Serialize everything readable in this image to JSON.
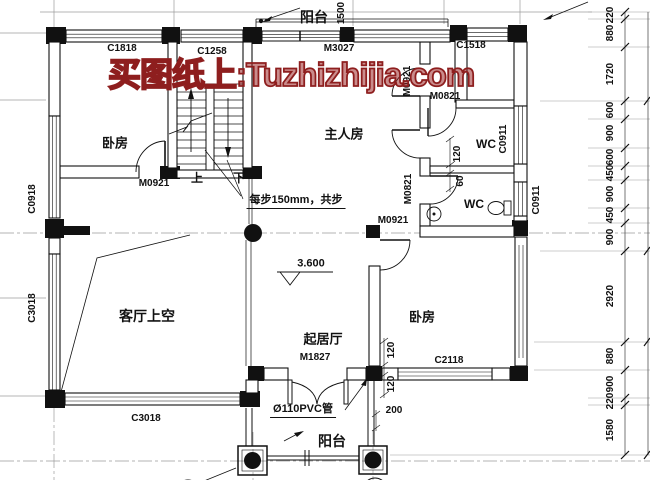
{
  "title": "second-floor house plan drawing",
  "watermark": {
    "text": "买图纸上:Tuzhizhijia.com",
    "color": "#8e1e1e"
  },
  "colors": {
    "line": "#1a1a1a",
    "grid": "#9b9b9b",
    "watermark": "#8e1e1e",
    "background": "#ffffff"
  },
  "labels": [
    {
      "name": "balcony-top-label",
      "text": "阳台",
      "x": 314,
      "y": 17,
      "fs": 14
    },
    {
      "name": "window-c1818-label",
      "text": "C1818",
      "x": 122,
      "y": 49,
      "fs": 10
    },
    {
      "name": "window-c1258-label",
      "text": "C1258",
      "x": 212,
      "y": 52,
      "fs": 10
    },
    {
      "name": "door-m3027-label",
      "text": "M3027",
      "x": 339,
      "y": 49,
      "fs": 10
    },
    {
      "name": "window-c1518-label",
      "text": "C1518",
      "x": 471,
      "y": 46,
      "fs": 10
    },
    {
      "name": "dim-1500-label",
      "text": "1500",
      "x": 342,
      "y": 13,
      "fs": 10,
      "rot": 1
    },
    {
      "name": "door-m0921-corridor-label",
      "text": "M0921",
      "x": 408,
      "y": 81,
      "fs": 10,
      "rot": 1
    },
    {
      "name": "door-m0821-top-label",
      "text": "M0821",
      "x": 445,
      "y": 97,
      "fs": 10
    },
    {
      "name": "wc-upper-label",
      "text": "WC",
      "x": 486,
      "y": 144,
      "fs": 12
    },
    {
      "name": "window-c0911-upper-label",
      "text": "C0911",
      "x": 504,
      "y": 139,
      "fs": 10,
      "rot": 1
    },
    {
      "name": "dim-120-wc-label",
      "text": "120",
      "x": 458,
      "y": 154,
      "fs": 10,
      "rot": 1
    },
    {
      "name": "dim-60-wc-label",
      "text": "60",
      "x": 461,
      "y": 181,
      "fs": 10,
      "rot": 1
    },
    {
      "name": "door-m0821-lower-label",
      "text": "M0821",
      "x": 409,
      "y": 189,
      "fs": 10,
      "rot": 1
    },
    {
      "name": "wc-lower-label",
      "text": "WC",
      "x": 474,
      "y": 204,
      "fs": 12
    },
    {
      "name": "window-c0911-right-label",
      "text": "C0911",
      "x": 537,
      "y": 200,
      "fs": 10,
      "rot": 1
    },
    {
      "name": "room-master-label",
      "text": "主人房",
      "x": 344,
      "y": 134,
      "fs": 13
    },
    {
      "name": "room-bedroom-upperleft-label",
      "text": "卧房",
      "x": 115,
      "y": 143,
      "fs": 13
    },
    {
      "name": "door-m0921-bedroom1-label",
      "text": "M0921",
      "x": 154,
      "y": 184,
      "fs": 10
    },
    {
      "name": "stair-up-label",
      "text": "上",
      "x": 197,
      "y": 178,
      "fs": 12
    },
    {
      "name": "stair-down-label",
      "text": "下",
      "x": 239,
      "y": 178,
      "fs": 12
    },
    {
      "name": "stair-note-label",
      "text": "每步150mm，共步",
      "x": 296,
      "y": 202,
      "fs": 11,
      "u": 1
    },
    {
      "name": "door-m0921-bedroom2-label",
      "text": "M0921",
      "x": 393,
      "y": 221,
      "fs": 10
    },
    {
      "name": "window-c0918-label",
      "text": "C0918",
      "x": 33,
      "y": 199,
      "fs": 10,
      "rot": 1
    },
    {
      "name": "window-c3018-left-label",
      "text": "C3018",
      "x": 33,
      "y": 308,
      "fs": 10,
      "rot": 1
    },
    {
      "name": "room-void-label",
      "text": "客厅上空",
      "x": 147,
      "y": 316,
      "fs": 14
    },
    {
      "name": "level-3600-label",
      "text": "3.600",
      "x": 311,
      "y": 264,
      "fs": 11
    },
    {
      "name": "room-family-label",
      "text": "起居厅",
      "x": 323,
      "y": 339,
      "fs": 13
    },
    {
      "name": "door-m1827-label",
      "text": "M1827",
      "x": 315,
      "y": 358,
      "fs": 10
    },
    {
      "name": "room-bedroom-lowerright-label",
      "text": "卧房",
      "x": 422,
      "y": 317,
      "fs": 13
    },
    {
      "name": "window-c2118-label",
      "text": "C2118",
      "x": 449,
      "y": 361,
      "fs": 10
    },
    {
      "name": "dim-120-a-label",
      "text": "120",
      "x": 392,
      "y": 350,
      "fs": 10,
      "rot": 1
    },
    {
      "name": "dim-120-b-label",
      "text": "120",
      "x": 392,
      "y": 384,
      "fs": 10,
      "rot": 1
    },
    {
      "name": "dim-200-label",
      "text": "200",
      "x": 394,
      "y": 411,
      "fs": 10
    },
    {
      "name": "window-c3018-bottom-label",
      "text": "C3018",
      "x": 146,
      "y": 419,
      "fs": 10
    },
    {
      "name": "pvc-pipe-label",
      "text": "Ø110PVC管",
      "x": 303,
      "y": 411,
      "fs": 11,
      "u": 1
    },
    {
      "name": "balcony-bottom-label",
      "text": "阳台",
      "x": 332,
      "y": 441,
      "fs": 14
    }
  ],
  "right_dimension_chain": {
    "unit": "mm",
    "x": 611,
    "values": [
      220,
      880,
      1720,
      600,
      900,
      600,
      450,
      900,
      450,
      900,
      2920,
      880,
      900,
      220,
      1580
    ],
    "items": [
      {
        "text": "220",
        "y": 15
      },
      {
        "text": "880",
        "y": 33
      },
      {
        "text": "1720",
        "y": 74
      },
      {
        "text": "600",
        "y": 110
      },
      {
        "text": "900",
        "y": 133
      },
      {
        "text": "600",
        "y": 157
      },
      {
        "text": "450",
        "y": 173
      },
      {
        "text": "900",
        "y": 194
      },
      {
        "text": "450",
        "y": 215
      },
      {
        "text": "900",
        "y": 237
      },
      {
        "text": "2920",
        "y": 296
      },
      {
        "text": "880",
        "y": 356
      },
      {
        "text": "900",
        "y": 384
      },
      {
        "text": "220",
        "y": 401
      },
      {
        "text": "1580",
        "y": 430
      }
    ]
  }
}
